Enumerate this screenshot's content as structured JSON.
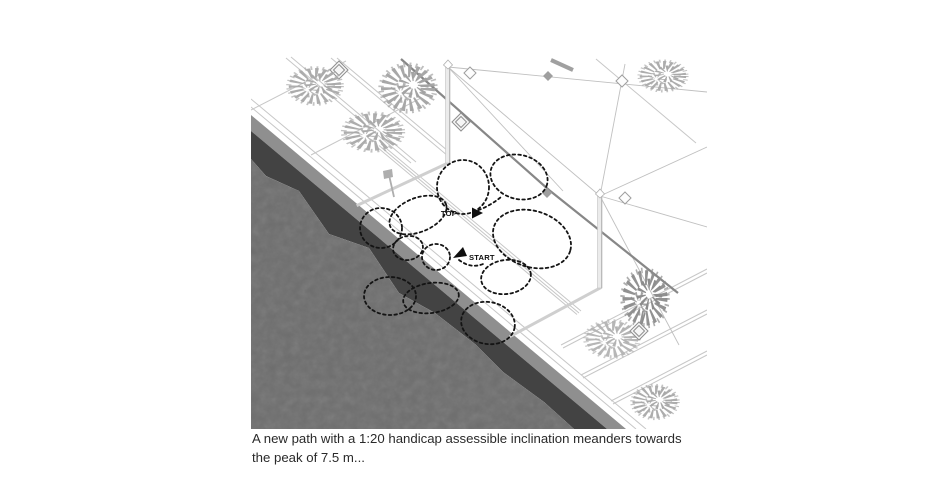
{
  "figure": {
    "type": "axonometric-site-diagram",
    "path_labels": {
      "top": "TOP",
      "start": "START"
    },
    "caption": {
      "line1": "A new path with a 1:20 handicap assessible inclination meanders towards",
      "line2": "the peak of 7.5 m..."
    },
    "colors": {
      "water": "#6e6e6e",
      "quay_shadow": "#434343",
      "quay_wall": "#8f8f8f",
      "path_dash": "#141414",
      "label_text": "#0f0f0f",
      "caption_text": "#2a2a2a",
      "foliage_light": "#a9a9a9",
      "foliage_dark": "#8c8c8c"
    }
  }
}
